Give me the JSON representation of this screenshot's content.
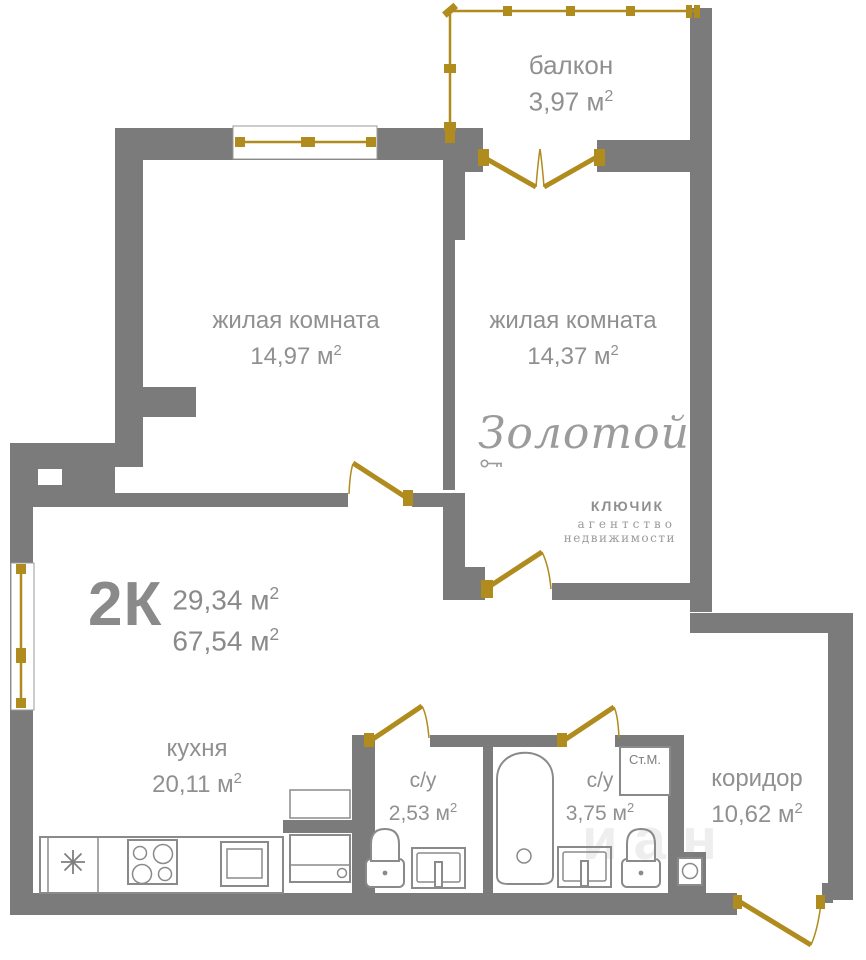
{
  "colors": {
    "wall": "#7b7b7b",
    "gold": "#b08b1d",
    "text": "#909090",
    "logo": "#9b9b9b",
    "fixture": "#8a8a8a"
  },
  "units": {
    "base": "м",
    "exp": "2"
  },
  "rooms": {
    "balcony": {
      "name": "балкон",
      "area": "3,97"
    },
    "living1": {
      "name": "жилая комната",
      "area": "14,97"
    },
    "living2": {
      "name": "жилая комната",
      "area": "14,37"
    },
    "kitchen": {
      "name": "кухня",
      "area": "20,11"
    },
    "bath1": {
      "name": "с/у",
      "area": "2,53"
    },
    "bath2": {
      "name": "с/у",
      "area": "3,75"
    },
    "corridor": {
      "name": "коридор",
      "area": "10,62"
    }
  },
  "summary": {
    "type": "2К",
    "area_living": "29,34",
    "area_total": "67,54"
  },
  "appliances": {
    "washing_machine": "Ст.М."
  },
  "logo": {
    "title": "Золотой",
    "subtitle": "КЛЮЧИК",
    "line1": "агентство",
    "line2": "недвижимости"
  },
  "watermark": "иан"
}
